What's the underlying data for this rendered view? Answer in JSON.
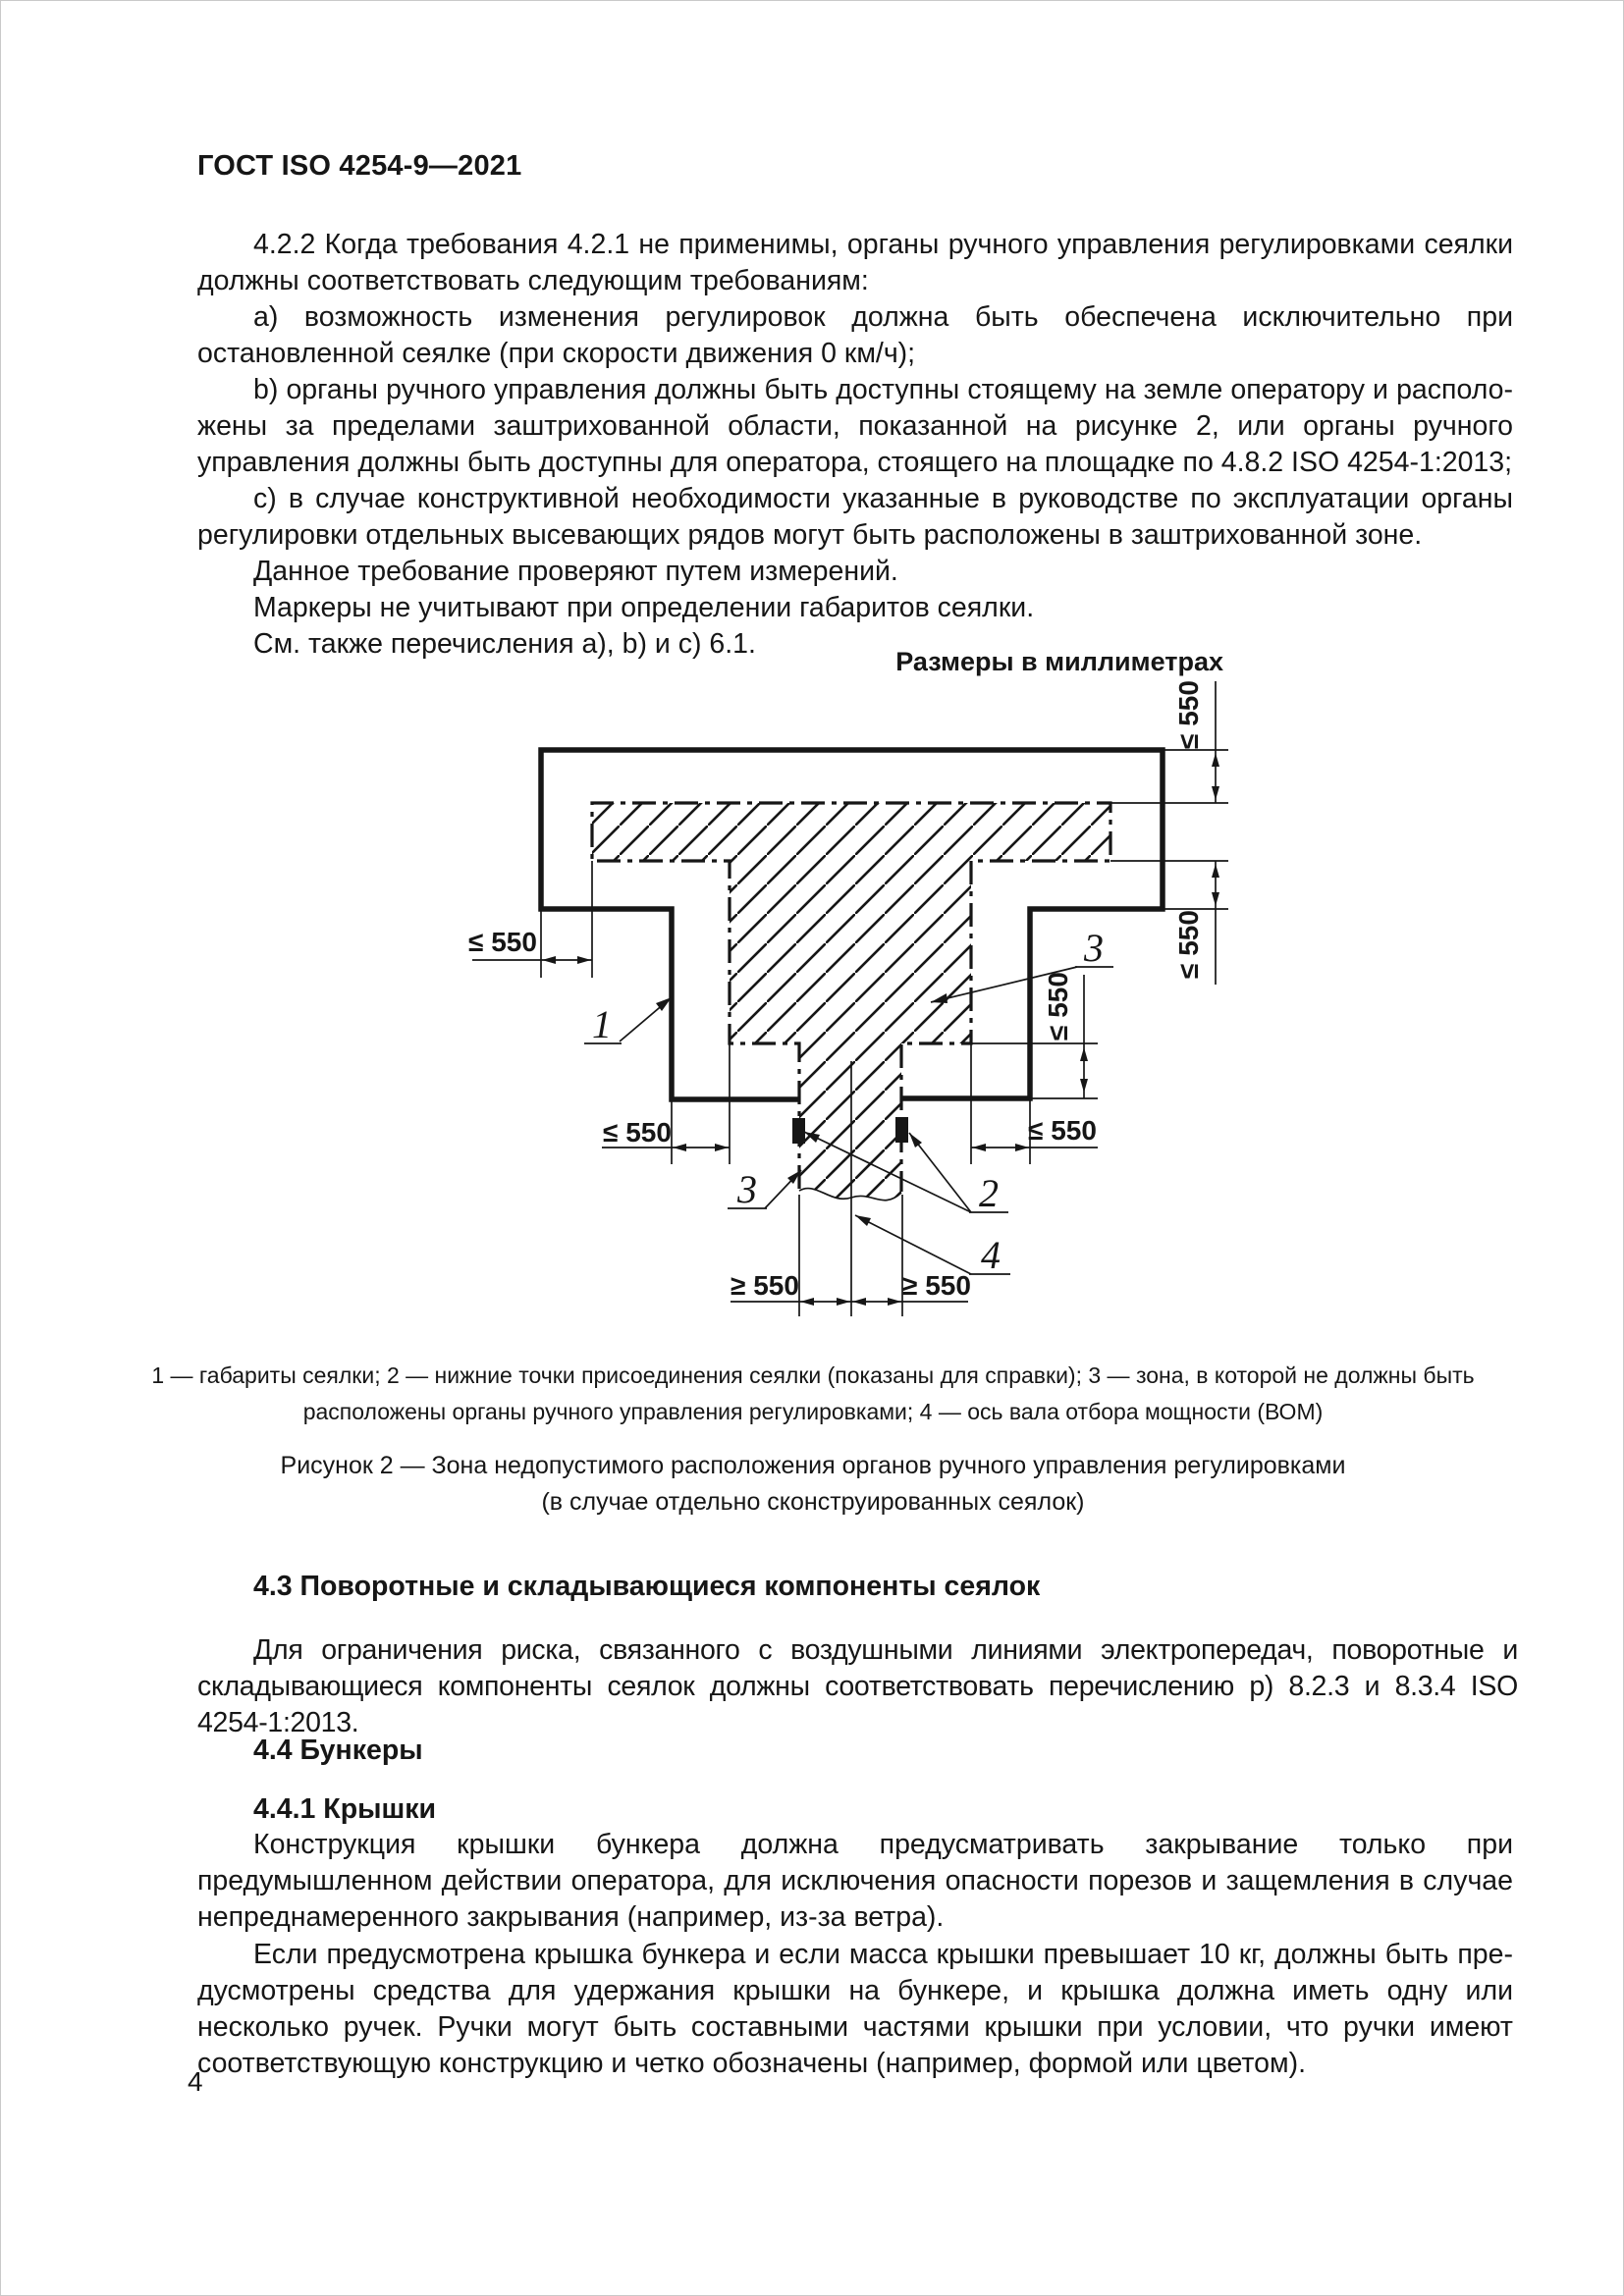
{
  "page": {
    "header": "ГОСТ ISO 4254-9—2021",
    "number": "4",
    "units_note": "Размеры в миллиметрах"
  },
  "body": {
    "p_422": "4.2.2 Когда требования 4.2.1 не применимы, органы ручного управления регулировками сеялки должны соответствовать следующим требованиям:",
    "item_a": "a) возможность изменения регулировок должна быть обеспечена исключительно при остановлен­ной сеялке (при скорости движения 0 км/ч);",
    "item_b": "b) органы ручного управления должны быть доступны стоящему на земле оператору и располо­жены за пределами заштрихованной области, показанной на рисунке 2, или органы ручного управления должны быть доступны для оператора, стоящего на площадке по 4.8.2 ISO 4254-1:2013;",
    "item_c": "c) в случае конструктивной необходимости указанные в руководстве по эксплуатации органы ре­гулировки отдельных высевающих рядов могут быть расположены в заштрихованной зоне.",
    "p_note1": "Данное требование проверяют путем измерений.",
    "p_note2": "Маркеры не учитывают при определении габаритов сеялки.",
    "p_note3": "См. также перечисления a), b) и c) 6.1."
  },
  "figure": {
    "dim_max": "≤ 550",
    "dim_min": "≥ 550",
    "callout_1": "1",
    "callout_2": "2",
    "callout_3": "3",
    "callout_4": "4",
    "legend_line1": "1 — габариты сеялки; 2 — нижние точки присоединения сеялки (показаны для справки); 3 — зона, в которой не должны быть",
    "legend_line2": "расположены органы ручного управления регулировками; 4 — ось вала отбора мощности (ВОМ)",
    "title_line1": "Рисунок 2 — Зона недопустимого расположения органов ручного управления регулировками",
    "title_line2": "(в случае отдельно сконструированных сеялок)"
  },
  "sections": {
    "s43_title": "4.3 Поворотные и складывающиеся компоненты сеялок",
    "s43_p1": "Для ограничения риска, связанного с воздушными линиями электропередач, поворотные и склады­вающиеся компоненты сеялок должны соответствовать перечислению p) 8.2.3 и 8.3.4 ISO 4254-1:2013.",
    "s44_title": "4.4 Бункеры",
    "s441_title": "4.4.1 Крышки",
    "s441_p1": "Конструкция крышки бункера должна предусматривать закрывание только при предумышленном действии оператора, для исключения опасности порезов и защемления в случае непреднамеренного закрывания (например, из-за ветра).",
    "s441_p2": "Если предусмотрена крышка бункера и если масса крышки превышает 10 кг, должны быть пре­дусмотрены средства для удержания крышки на бункере, и крышка должна иметь одну или несколько ручек. Ручки могут быть составными частями крышки при условии, что ручки имеют соответствующую конструкцию и четко обозначены (например, формой или цветом)."
  }
}
